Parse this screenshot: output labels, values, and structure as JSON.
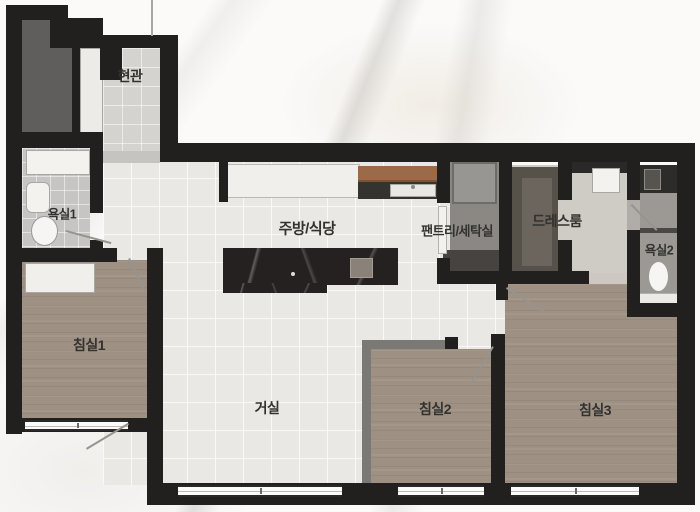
{
  "rooms": {
    "entrance": {
      "label": "현관"
    },
    "bathroom1": {
      "label": "욕실1"
    },
    "kitchen_dining": {
      "label": "주방/식당"
    },
    "pantry_laundry": {
      "label": "팬트리/세탁실"
    },
    "dressroom": {
      "label": "드레스룸"
    },
    "bathroom2": {
      "label": "욕실2"
    },
    "bedroom1": {
      "label": "침실1"
    },
    "living_room": {
      "label": "거실"
    },
    "bedroom2": {
      "label": "침실2"
    },
    "bedroom3": {
      "label": "침실3"
    }
  },
  "colors": {
    "wall": "#21201e",
    "tile_main": "#e9e8e4",
    "tile_entry": "#d5d3cf",
    "tile_bath": "#c6c5c3",
    "wood_floor": "#9e9184",
    "island_marble": "#242120",
    "counter_wood_brown": "#9a6a49",
    "closet_gray": "#5f5e5d",
    "partition_gray": "#7b7975",
    "dress_floor": "#cfccc5"
  },
  "fixtures": {
    "kitchen_island": "kitchen-island",
    "island_sink": "island-sink",
    "kitchen_counter": "kitchen-counter",
    "wood_counter": "wood-counter",
    "counter_sink": "counter-sink",
    "washer": "washing-machine",
    "pantry_cabinet": "pantry-cabinet",
    "wardrobe": "wardrobe",
    "drawer_unit": "drawer-unit",
    "shoe_cabinet": "shoe-cabinet",
    "vanity": "bath-vanity",
    "wash_basin": "wash-basin",
    "toilet1": "toilet",
    "toilet2": "toilet",
    "dresser": "bedroom-dresser",
    "windows": "window",
    "door_swings": "door-swing-line"
  }
}
